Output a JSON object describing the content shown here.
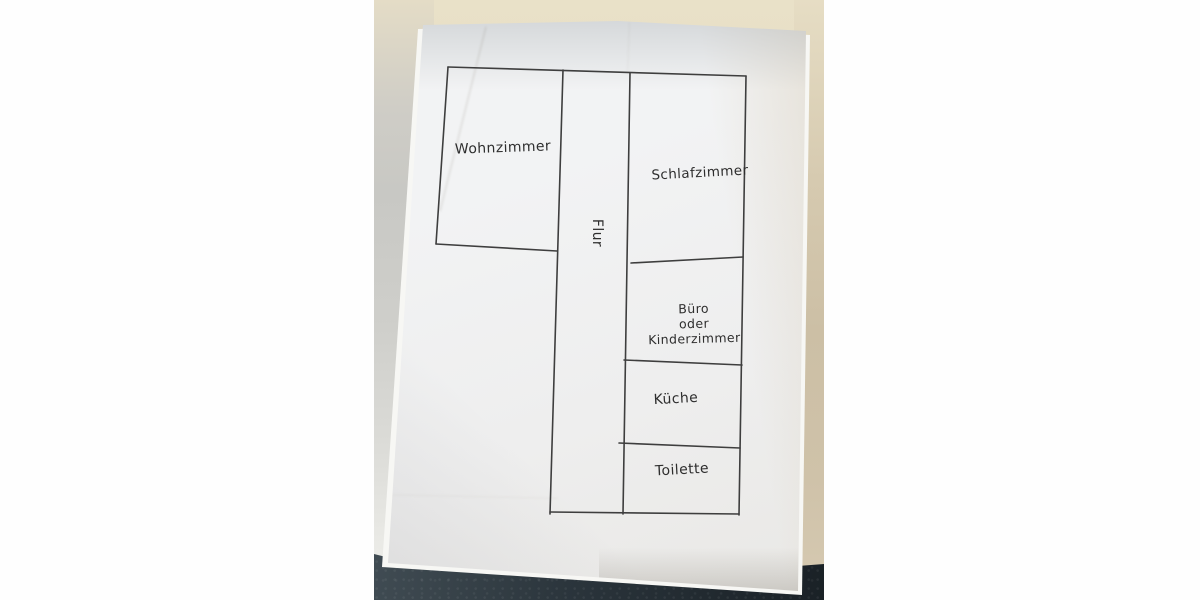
{
  "image_type": "photo of a hand-drawn apartment floor plan sketch on white paper",
  "floor_plan": {
    "rooms": [
      {
        "id": "wohnzimmer",
        "label": "Wohnzimmer"
      },
      {
        "id": "flur",
        "label": "Flur",
        "orientation": "vertical"
      },
      {
        "id": "schlafzimmer",
        "label": "Schlafzimmer"
      },
      {
        "id": "buero-kinderzimmer",
        "label": "Büro oder Kinderzimmer",
        "label_lines": [
          "Büro",
          "oder",
          "Kinderzimmer"
        ]
      },
      {
        "id": "kueche",
        "label": "Küche"
      },
      {
        "id": "toilette",
        "label": "Toilette"
      }
    ],
    "ink_color": "#3e3e3e",
    "paper_color": "#f0f1f2",
    "background_colors": {
      "wall_beige": "#e9e1c8",
      "table_dark": "#2a343b",
      "table_gray": "#c8c8c4"
    }
  }
}
